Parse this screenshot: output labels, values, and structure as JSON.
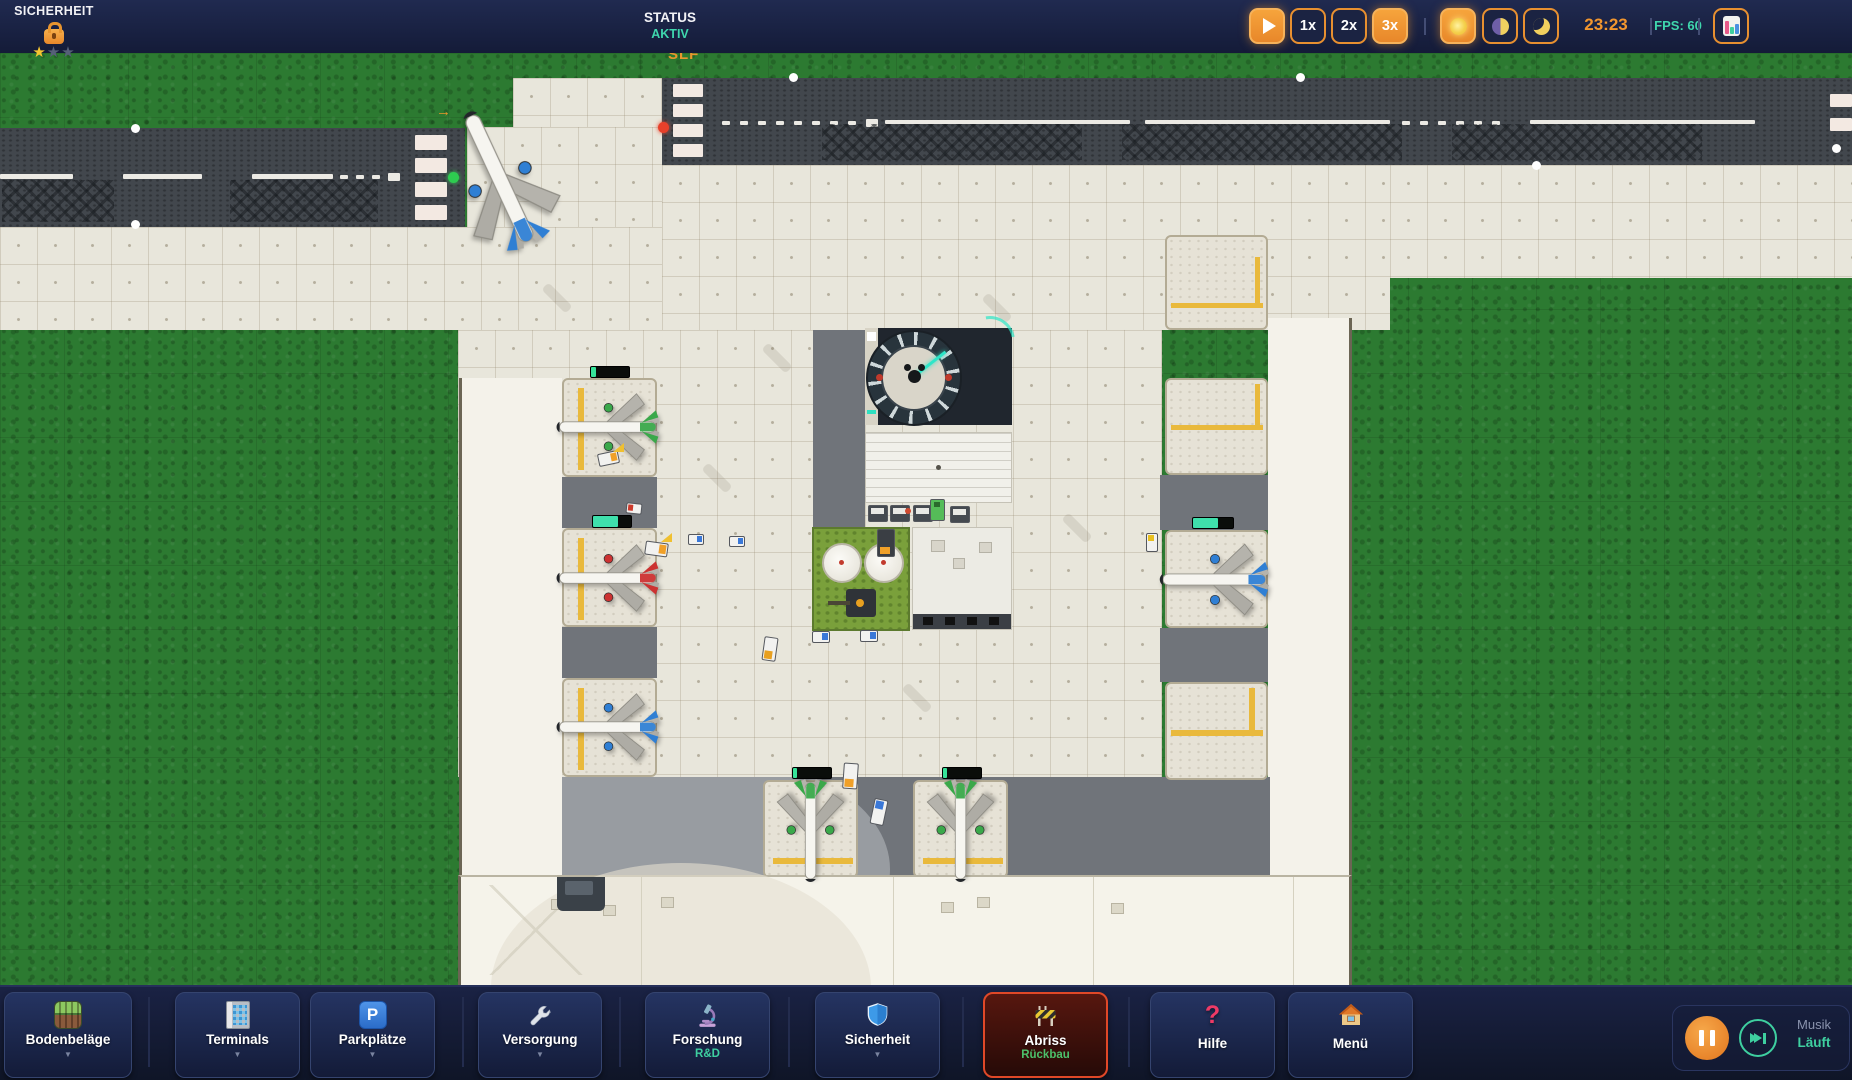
{
  "hud": {
    "top": {
      "security": {
        "title": "SICHERHEIT",
        "icon": "lock-icon",
        "star_glyph": "★",
        "stars_filled": 1,
        "stars_total": 3
      },
      "status": {
        "label": "STATUS",
        "value": "AKTIV",
        "value_color": "#3fd6ad"
      },
      "speed": {
        "play_icon": "play-icon",
        "play_active": true,
        "options": [
          {
            "label": "1x",
            "active": false
          },
          {
            "label": "2x",
            "active": false
          },
          {
            "label": "3x",
            "active": true
          }
        ]
      },
      "time_of_day": [
        {
          "name": "day",
          "icon": "sun-icon",
          "active": true
        },
        {
          "name": "dusk",
          "icon": "half-moon-icon",
          "active": false
        },
        {
          "name": "night",
          "icon": "moon-icon",
          "active": false
        }
      ],
      "clock": "23:23",
      "fps": "FPS: 60",
      "stats_icon": "bar-chart-icon"
    },
    "bottom": {
      "caret_glyph": "▼",
      "buttons": [
        {
          "label": "Bodenbeläge",
          "icon": "flooring-icon",
          "caret": true
        },
        {
          "label": "Terminals",
          "icon": "building-icon",
          "caret": true
        },
        {
          "label": "Parkplätze",
          "icon": "parking-icon",
          "icon_letter": "P",
          "caret": true
        },
        {
          "label": "Versorgung",
          "icon": "wrench-icon",
          "caret": true
        },
        {
          "label": "Forschung",
          "sub": "R&D",
          "icon": "microscope-icon"
        },
        {
          "label": "Sicherheit",
          "icon": "shield-icon",
          "caret": true
        },
        {
          "label": "Abriss",
          "sub": "Rückbau",
          "icon": "barrier-icon",
          "active": true
        },
        {
          "label": "Hilfe",
          "icon": "question-icon",
          "icon_glyph": "?"
        },
        {
          "label": "Menü",
          "icon": "house-icon"
        }
      ],
      "music": {
        "title": "Musik",
        "status": "Läuft",
        "pause_icon": "pause-icon",
        "skip_icon": "skip-track-icon"
      }
    }
  },
  "map": {
    "runway_exit_label": "SLF",
    "hold_arrow": "→",
    "plane_tail_colors": {
      "stand_left_1": "#3aa84a",
      "stand_left_2": "#cc3231",
      "stand_left_3": "#2f7fd4",
      "stand_right": "#2f7fd4",
      "stand_south_a": "#3aa84a",
      "stand_south_b": "#3aa84a",
      "runway_departure": "#2f7fd4"
    },
    "colors": {
      "grass": "#2c7a31",
      "taxiway": "#e8e6db",
      "runway": "#42474d",
      "apron_gray": "#70747a",
      "stand_marking_yellow": "#e9b93c",
      "progress_green": "#36e49a"
    }
  },
  "theme": {
    "navy": "#1a2244",
    "accent_orange": "#f0962f",
    "teal": "#3ecfa0",
    "alert_red": "#e04828",
    "star_gold": "#f5c531"
  }
}
